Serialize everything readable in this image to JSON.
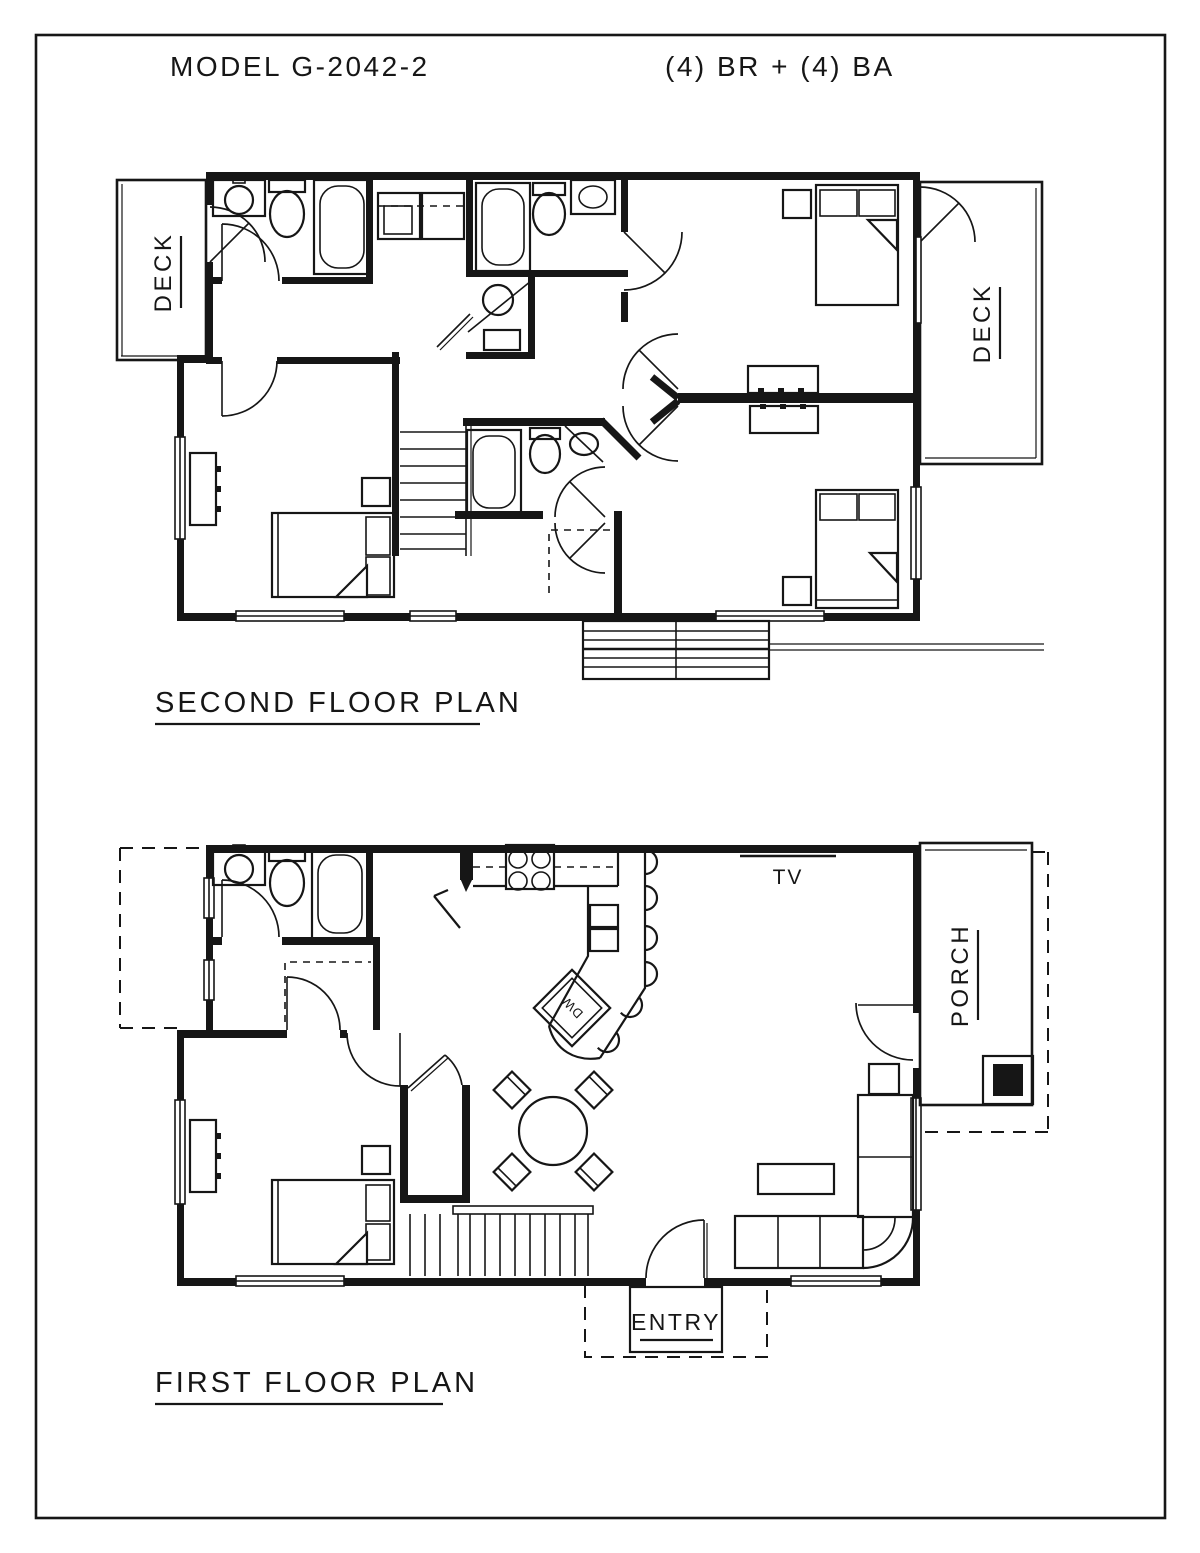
{
  "title": {
    "model": "MODEL G-2042-2",
    "specs": "(4) BR + (4) BA"
  },
  "second_floor": {
    "label": "SECOND FLOOR PLAN",
    "deck_left": "DECK",
    "deck_right": "DECK"
  },
  "first_floor": {
    "label": "FIRST FLOOR PLAN",
    "tv": "TV",
    "porch": "PORCH",
    "entry": "ENTRY",
    "dishwasher": "DW"
  },
  "colors": {
    "ink": "#161616",
    "paper": "#ffffff"
  }
}
